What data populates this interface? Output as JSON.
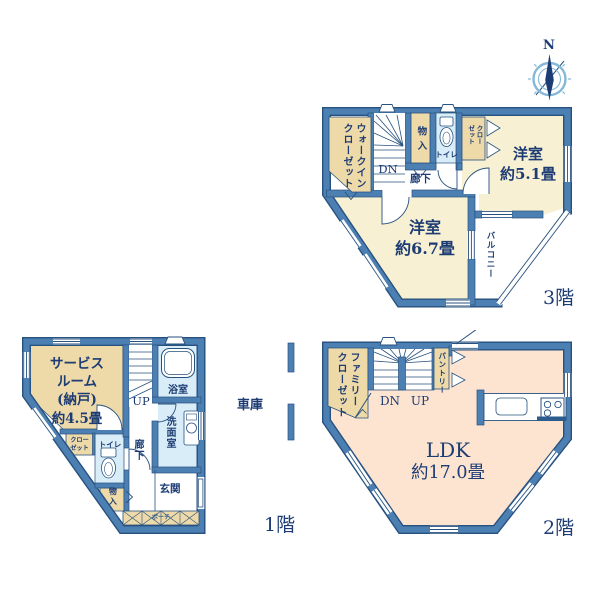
{
  "compass": {
    "north": "N"
  },
  "floor3": {
    "label": "3階",
    "walkin_closet": [
      "ウォークイン",
      "クローゼット"
    ],
    "storage": "物入",
    "toilet": "トイレ",
    "closet": [
      "クロー",
      "ゼット"
    ],
    "stairs_dn": "DN",
    "hallway": "廊下",
    "room_5_1": [
      "洋室",
      "約5.1畳"
    ],
    "room_6_7": [
      "洋室",
      "約6.7畳"
    ],
    "balcony": "バルコニー"
  },
  "floor1": {
    "label": "1階",
    "service_room": [
      "サービス",
      "ルーム",
      "(納戸)",
      "約4.5畳"
    ],
    "stairs_up": "UP",
    "bath": "浴室",
    "washroom": "洗面室",
    "closet": [
      "クロー",
      "ゼット"
    ],
    "toilet": "トイレ",
    "hallway": "廊下",
    "storage": "物入",
    "entrance": "玄関",
    "porch": "ポーチ",
    "garage": "車庫"
  },
  "floor2": {
    "label": "2階",
    "family_closet": [
      "ファミリー",
      "クローゼット"
    ],
    "stairs_dn": "DN",
    "stairs_up": "UP",
    "pantry": "パントリー",
    "ldk": [
      "LDK",
      "約17.0畳"
    ]
  },
  "colors": {
    "wall": "#4d80b2",
    "line": "#27517f",
    "room_cream": "#f8f0d2",
    "closet_tan": "#eed9a8",
    "wet_blue": "#d9edf8",
    "ldk_peach": "#fce4d0",
    "text_navy": "#1d3c74",
    "compass_blue": "#85b8d8"
  }
}
